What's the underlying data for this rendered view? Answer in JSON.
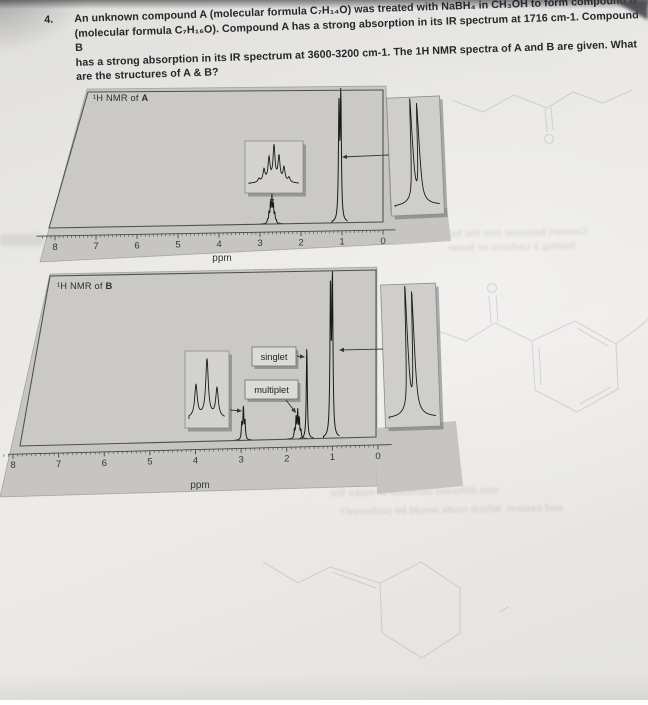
{
  "question": {
    "number": "4.",
    "lines": [
      "An unknown compound A (molecular formula C₇H₁₄O) was treated with NaBH₄ in CH₃OH to form compound B",
      "(molecular formula C₇H₁₆O).  Compound A has a strong absorption in its IR spectrum at 1716 cm-1.  Compound B",
      "has a strong absorption in its IR spectrum at 3600-3200 cm-1.  The 1H NMR spectra of A and B are given.  What",
      "are the structures of A & B?"
    ]
  },
  "chart_data": [
    {
      "id": "A",
      "type": "line",
      "title_prefix": "¹H NMR of ",
      "title_letter": "A",
      "xlabel": "ppm",
      "x_ticks": [
        8,
        7,
        6,
        5,
        4,
        3,
        2,
        1,
        0
      ],
      "x_range": [
        8.45,
        -0.3
      ],
      "grid": false,
      "peaks": [
        {
          "name": "methine-septet",
          "ppm": 2.71,
          "multiplicity": "septet",
          "rel_height": 0.2,
          "g": 0.5,
          "components": [
            [
              -0.105,
              0.1
            ],
            [
              -0.07,
              0.34
            ],
            [
              -0.035,
              0.68
            ],
            [
              0,
              1
            ],
            [
              0.035,
              0.7
            ],
            [
              0.07,
              0.38
            ],
            [
              0.105,
              0.12
            ]
          ]
        },
        {
          "name": "methyl-doublet",
          "ppm": 1.05,
          "multiplicity": "doublet",
          "rel_height": 0.93,
          "g": 0.65,
          "components": [
            [
              -0.022,
              1
            ],
            [
              0.022,
              0.93
            ]
          ]
        }
      ],
      "insets": [
        {
          "name": "septet-expansion",
          "g": 1.15,
          "pattern": [
            [
              -15,
              0.1
            ],
            [
              -10,
              0.34
            ],
            [
              -5,
              0.66
            ],
            [
              0,
              1
            ],
            [
              5,
              0.7
            ],
            [
              10,
              0.4
            ],
            [
              15,
              0.13
            ]
          ]
        },
        {
          "name": "doublet-expansion",
          "g": 1.0,
          "pattern": [
            [
              -3.3,
              1
            ],
            [
              3.3,
              0.95
            ]
          ]
        }
      ],
      "annotations": []
    },
    {
      "id": "B",
      "type": "line",
      "title_prefix": "¹H NMR of ",
      "title_letter": "B",
      "xlabel": "ppm",
      "x_ticks": [
        8,
        7,
        6,
        5,
        4,
        3,
        2,
        1,
        0
      ],
      "x_range": [
        8.1,
        -0.3
      ],
      "grid": false,
      "peaks": [
        {
          "name": "methine-multiplet",
          "ppm": 2.95,
          "multiplicity": "multiplet",
          "rel_height": 0.19,
          "g": 0.55,
          "components": [
            [
              -0.035,
              0.55
            ],
            [
              0,
              1
            ],
            [
              0.035,
              0.5
            ]
          ]
        },
        {
          "name": "ch-multiplet",
          "ppm": 1.76,
          "multiplicity": "multiplet",
          "rel_height": 0.16,
          "g": 0.5,
          "components": [
            [
              -0.07,
              0.3
            ],
            [
              -0.035,
              0.72
            ],
            [
              0,
              1
            ],
            [
              0.035,
              0.78
            ],
            [
              0.07,
              0.33
            ]
          ]
        },
        {
          "name": "oh-singlet",
          "ppm": 1.56,
          "multiplicity": "singlet",
          "rel_height": 0.55,
          "g": 0.6,
          "components": [
            [
              0,
              1
            ]
          ]
        },
        {
          "name": "methyl-doublet",
          "ppm": 1.02,
          "multiplicity": "doublet",
          "rel_height": 0.93,
          "g": 0.65,
          "components": [
            [
              -0.021,
              1
            ],
            [
              0.021,
              0.94
            ]
          ]
        }
      ],
      "insets": [
        {
          "name": "methine-multiplet-expansion",
          "g": 1.5,
          "pattern": [
            [
              -11,
              0.56
            ],
            [
              0,
              1
            ],
            [
              10,
              0.5
            ]
          ]
        },
        {
          "name": "doublet-expansion",
          "g": 1.0,
          "pattern": [
            [
              -3.3,
              1
            ],
            [
              3.3,
              0.95
            ]
          ]
        }
      ],
      "annotations": [
        {
          "label": "singlet"
        },
        {
          "label": "multiplet"
        }
      ]
    }
  ],
  "bleedthrough": {
    "sketches": [
      "chain-ketone-structure",
      "aryl-ketone-structure",
      "alkene-cyclohexane-structure"
    ],
    "texts": [
      {
        "text": "Convert benzene into the follo"
      },
      {
        "text": "having 3 carbons or fewer"
      },
      {
        "text": "two different methods to make the"
      },
      {
        "text": "and easiest.  Which route would be preferred?"
      }
    ]
  },
  "colors": {
    "paper": "#e8e7e4",
    "panel": "#c6c5c2",
    "panel_inner": "#cac9c6",
    "inset": "#d3d2cf",
    "label_box": "#dcdbd8",
    "ink": "#1a1a1d",
    "frame": "#4e4e52",
    "axis_text": "#36363b",
    "question_text": "#26262b",
    "bleed": "#6a6a78"
  }
}
